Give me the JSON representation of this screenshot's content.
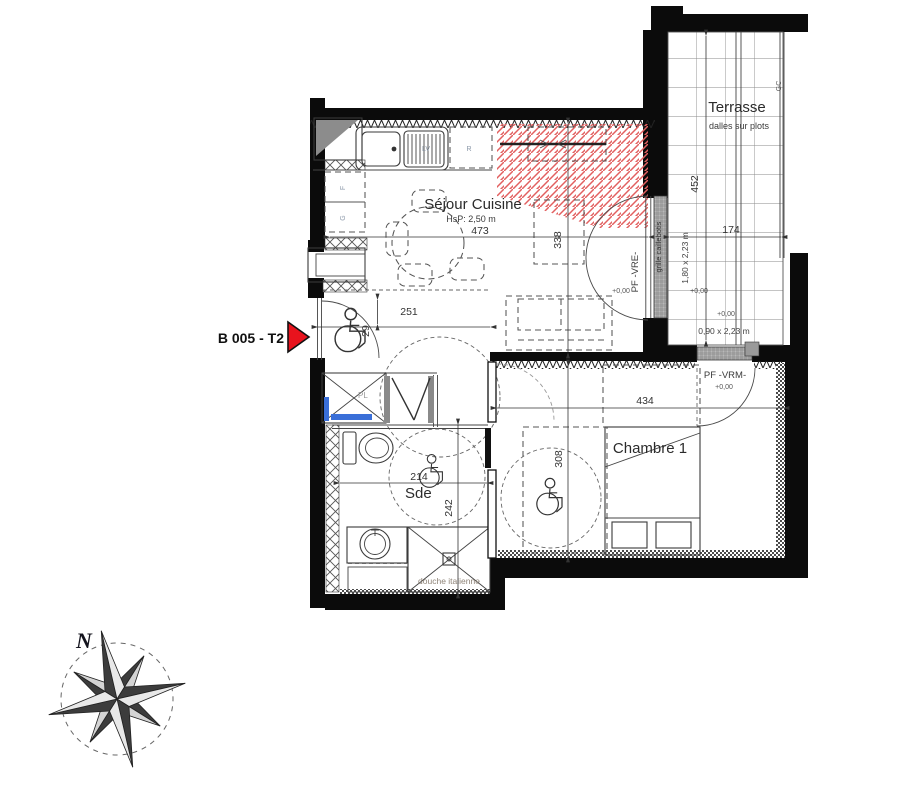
{
  "unit": {
    "label": "B 005 - T2"
  },
  "compass": {
    "north": "N"
  },
  "sejour": {
    "name": "Séjour Cuisine",
    "ceiling": "HsP: 2,50 m",
    "w": "473",
    "h": "338",
    "level": "+0,00"
  },
  "kitchen": {
    "lv": "LV",
    "r": "R",
    "top": "F",
    "bottom": "G"
  },
  "terrasse": {
    "name": "Terrasse",
    "finish": "dalles sur plots",
    "h": "452",
    "w": "174",
    "level_upper": "+0,00",
    "level_lower": "+0,00",
    "gc": "GC"
  },
  "vre": {
    "label": "PF -VRE-",
    "size": "1,80 x 2,23 m",
    "grille": "grille caillebotis"
  },
  "vrm": {
    "label": "PF -VRM-",
    "size": "0,90 x 2,23 m",
    "level": "+0,00"
  },
  "chambre": {
    "name": "Chambre 1",
    "w": "434",
    "h": "308"
  },
  "sde": {
    "name": "Sde",
    "w": "214",
    "h": "242",
    "shower": "douche italienne"
  },
  "entree": {
    "w": "251",
    "door": "29",
    "closet": "PL"
  },
  "colors": {
    "wall": "#0b0b0b",
    "accent_red": "#e8131d",
    "hatch_red": "#e26060",
    "fixture_blue": "#3a6fd8"
  }
}
